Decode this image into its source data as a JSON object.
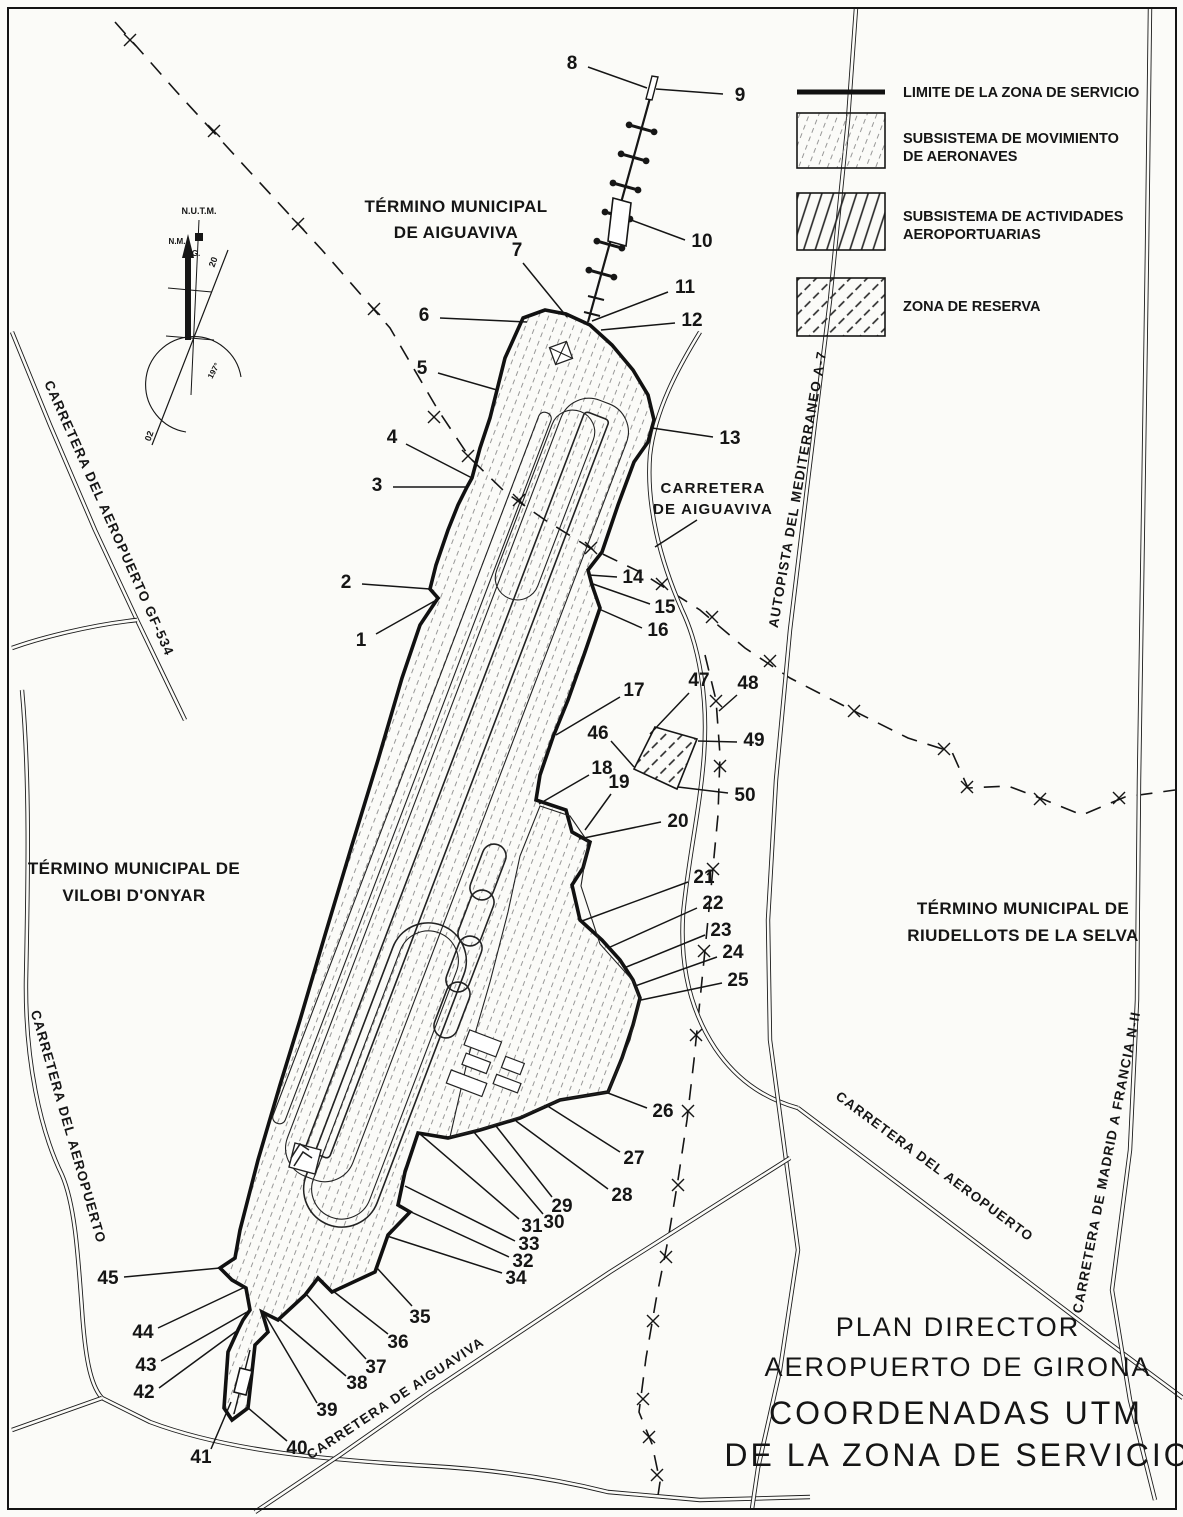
{
  "title_block": {
    "line1": "PLAN DIRECTOR",
    "line2": "AEROPUERTO DE GIRONA",
    "line3": "COORDENADAS UTM",
    "line4": "DE LA ZONA DE SERVICIO"
  },
  "legend": {
    "limit_label": "LIMITE DE LA ZONA DE SERVICIO",
    "movement_line1": "SUBSISTEMA DE MOVIMIENTO",
    "movement_line2": "DE AERONAVES",
    "activities_line1": "SUBSISTEMA DE ACTIVIDADES",
    "activities_line2": "AEROPORTUARIAS",
    "reserve_label": "ZONA DE RESERVA"
  },
  "municipalities": {
    "aiguaviva_line1": "TÉRMINO MUNICIPAL",
    "aiguaviva_line2": "DE AIGUAVIVA",
    "vilobi_line1": "TÉRMINO MUNICIPAL DE",
    "vilobi_line2": "VILOBI D'ONYAR",
    "riudellots_line1": "TÉRMINO MUNICIPAL DE",
    "riudellots_line2": "RIUDELLOTS DE LA SELVA"
  },
  "roads": {
    "gf534": "CARRETERA DEL AEROPUERTO GF-534",
    "aeropuerto_west": "CARRETERA DEL AEROPUERTO",
    "aiguaviva_line1": "CARRETERA",
    "aiguaviva_line2": "DE AIGUAVIVA",
    "a7": "AUTOPISTA DEL MEDITERRANEO A-7",
    "aeropuerto_east": "CARRETERA DEL AEROPUERTO",
    "n2": "CARRETERA DE MADRID A FRANCIA N-II",
    "aiguaviva_south": "CARRETERA DE AIGUAVIVA"
  },
  "compass": {
    "utm": "N.U.T.M.",
    "nm": "N.M.",
    "ng": "N.G.",
    "rw20": "20",
    "rw02": "02",
    "arc": "197°"
  },
  "callouts": [
    {
      "n": "1",
      "label": [
        361,
        641
      ],
      "from": [
        376,
        634
      ],
      "to": [
        440,
        598
      ]
    },
    {
      "n": "2",
      "label": [
        346,
        583
      ],
      "from": [
        362,
        584
      ],
      "to": [
        430,
        589
      ]
    },
    {
      "n": "3",
      "label": [
        377,
        486
      ],
      "from": [
        393,
        487
      ],
      "to": [
        467,
        487
      ]
    },
    {
      "n": "4",
      "label": [
        392,
        438
      ],
      "from": [
        406,
        444
      ],
      "to": [
        472,
        478
      ]
    },
    {
      "n": "5",
      "label": [
        422,
        369
      ],
      "from": [
        438,
        373
      ],
      "to": [
        497,
        390
      ]
    },
    {
      "n": "6",
      "label": [
        424,
        316
      ],
      "from": [
        440,
        318
      ],
      "to": [
        527,
        322
      ]
    },
    {
      "n": "7",
      "label": [
        517,
        251
      ],
      "from": [
        523,
        263
      ],
      "to": [
        567,
        317
      ]
    },
    {
      "n": "8",
      "label": [
        572,
        64
      ],
      "from": [
        588,
        67
      ],
      "to": [
        647,
        88
      ]
    },
    {
      "n": "9",
      "label": [
        740,
        96
      ],
      "from": [
        723,
        94
      ],
      "to": [
        656,
        89
      ]
    },
    {
      "n": "10",
      "label": [
        702,
        242
      ],
      "from": [
        685,
        240
      ],
      "to": [
        631,
        220
      ]
    },
    {
      "n": "11",
      "label": [
        685,
        288
      ],
      "from": [
        668,
        292
      ],
      "to": [
        592,
        321
      ]
    },
    {
      "n": "12",
      "label": [
        692,
        321
      ],
      "from": [
        675,
        323
      ],
      "to": [
        601,
        330
      ]
    },
    {
      "n": "13",
      "label": [
        730,
        439
      ],
      "from": [
        713,
        437
      ],
      "to": [
        652,
        428
      ]
    },
    {
      "n": "14",
      "label": [
        633,
        578
      ],
      "from": [
        617,
        577
      ],
      "to": [
        589,
        575
      ]
    },
    {
      "n": "15",
      "label": [
        665,
        608
      ],
      "from": [
        650,
        604
      ],
      "to": [
        593,
        584
      ]
    },
    {
      "n": "16",
      "label": [
        658,
        631
      ],
      "from": [
        642,
        628
      ],
      "to": [
        599,
        609
      ]
    },
    {
      "n": "17",
      "label": [
        634,
        691
      ],
      "from": [
        620,
        697
      ],
      "to": [
        556,
        735
      ]
    },
    {
      "n": "18",
      "label": [
        602,
        769
      ],
      "from": [
        589,
        775
      ],
      "to": [
        539,
        804
      ]
    },
    {
      "n": "19",
      "label": [
        619,
        783
      ],
      "from": [
        611,
        794
      ],
      "to": [
        585,
        830
      ]
    },
    {
      "n": "20",
      "label": [
        678,
        822
      ],
      "from": [
        661,
        822
      ],
      "to": [
        579,
        839
      ]
    },
    {
      "n": "21",
      "label": [
        704,
        878
      ],
      "from": [
        688,
        882
      ],
      "to": [
        582,
        921
      ]
    },
    {
      "n": "22",
      "label": [
        713,
        904
      ],
      "from": [
        697,
        908
      ],
      "to": [
        608,
        948
      ]
    },
    {
      "n": "23",
      "label": [
        721,
        931
      ],
      "from": [
        705,
        935
      ],
      "to": [
        624,
        968
      ]
    },
    {
      "n": "24",
      "label": [
        733,
        953
      ],
      "from": [
        717,
        957
      ],
      "to": [
        635,
        986
      ]
    },
    {
      "n": "25",
      "label": [
        738,
        981
      ],
      "from": [
        722,
        983
      ],
      "to": [
        641,
        1000
      ]
    },
    {
      "n": "26",
      "label": [
        663,
        1112
      ],
      "from": [
        647,
        1108
      ],
      "to": [
        608,
        1093
      ]
    },
    {
      "n": "27",
      "label": [
        634,
        1159
      ],
      "from": [
        620,
        1152
      ],
      "to": [
        546,
        1105
      ]
    },
    {
      "n": "28",
      "label": [
        622,
        1196
      ],
      "from": [
        608,
        1189
      ],
      "to": [
        516,
        1121
      ]
    },
    {
      "n": "29",
      "label": [
        562,
        1207
      ],
      "from": [
        552,
        1197
      ],
      "to": [
        496,
        1126
      ]
    },
    {
      "n": "30",
      "label": [
        554,
        1223
      ],
      "from": [
        543,
        1214
      ],
      "to": [
        473,
        1131
      ]
    },
    {
      "n": "31",
      "label": [
        532,
        1227
      ],
      "from": [
        519,
        1219
      ],
      "to": [
        420,
        1134
      ]
    },
    {
      "n": "32",
      "label": [
        523,
        1262
      ],
      "from": [
        509,
        1257
      ],
      "to": [
        398,
        1206
      ]
    },
    {
      "n": "33",
      "label": [
        529,
        1245
      ],
      "from": [
        515,
        1241
      ],
      "to": [
        405,
        1186
      ]
    },
    {
      "n": "34",
      "label": [
        516,
        1279
      ],
      "from": [
        502,
        1273
      ],
      "to": [
        387,
        1236
      ]
    },
    {
      "n": "35",
      "label": [
        420,
        1318
      ],
      "from": [
        412,
        1306
      ],
      "to": [
        377,
        1268
      ]
    },
    {
      "n": "36",
      "label": [
        398,
        1343
      ],
      "from": [
        388,
        1334
      ],
      "to": [
        333,
        1291
      ]
    },
    {
      "n": "37",
      "label": [
        376,
        1368
      ],
      "from": [
        366,
        1359
      ],
      "to": [
        306,
        1294
      ]
    },
    {
      "n": "38",
      "label": [
        357,
        1384
      ],
      "from": [
        346,
        1376
      ],
      "to": [
        279,
        1319
      ]
    },
    {
      "n": "39",
      "label": [
        327,
        1411
      ],
      "from": [
        317,
        1403
      ],
      "to": [
        265,
        1315
      ]
    },
    {
      "n": "40",
      "label": [
        297,
        1449
      ],
      "from": [
        287,
        1441
      ],
      "to": [
        247,
        1407
      ]
    },
    {
      "n": "41",
      "label": [
        201,
        1458
      ],
      "from": [
        211,
        1449
      ],
      "to": [
        231,
        1402
      ]
    },
    {
      "n": "42",
      "label": [
        144,
        1393
      ],
      "from": [
        159,
        1388
      ],
      "to": [
        238,
        1330
      ]
    },
    {
      "n": "43",
      "label": [
        146,
        1366
      ],
      "from": [
        161,
        1361
      ],
      "to": [
        247,
        1312
      ]
    },
    {
      "n": "44",
      "label": [
        143,
        1333
      ],
      "from": [
        158,
        1328
      ],
      "to": [
        245,
        1287
      ]
    },
    {
      "n": "45",
      "label": [
        108,
        1279
      ],
      "from": [
        124,
        1277
      ],
      "to": [
        220,
        1268
      ]
    },
    {
      "n": "46",
      "label": [
        598,
        734
      ],
      "from": [
        611,
        741
      ],
      "to": [
        634,
        767
      ]
    },
    {
      "n": "47",
      "label": [
        699,
        681
      ],
      "from": [
        689,
        693
      ],
      "to": [
        650,
        734
      ]
    },
    {
      "n": "48",
      "label": [
        748,
        684
      ],
      "from": [
        737,
        695
      ],
      "to": [
        719,
        711
      ]
    },
    {
      "n": "49",
      "label": [
        754,
        741
      ],
      "from": [
        737,
        742
      ],
      "to": [
        698,
        741
      ]
    },
    {
      "n": "50",
      "label": [
        745,
        796
      ],
      "from": [
        728,
        793
      ],
      "to": [
        678,
        787
      ]
    }
  ],
  "boundary_marks": [
    [
      130,
      40
    ],
    [
      214,
      131
    ],
    [
      298,
      224
    ],
    [
      374,
      309
    ],
    [
      434,
      417
    ],
    [
      468,
      456
    ],
    [
      519,
      500
    ],
    [
      591,
      548
    ],
    [
      662,
      584
    ],
    [
      712,
      617
    ],
    [
      770,
      661
    ],
    [
      854,
      711
    ],
    [
      944,
      749
    ],
    [
      967,
      787
    ],
    [
      1040,
      799
    ],
    [
      1119,
      798
    ],
    [
      716,
      701
    ],
    [
      720,
      766
    ],
    [
      713,
      869
    ],
    [
      704,
      951
    ],
    [
      696,
      1035
    ],
    [
      688,
      1111
    ],
    [
      678,
      1185
    ],
    [
      666,
      1257
    ],
    [
      653,
      1321
    ],
    [
      643,
      1399
    ],
    [
      649,
      1437
    ],
    [
      657,
      1475
    ]
  ],
  "colors": {
    "ink": "#151515",
    "paper": "#fbfbf8"
  }
}
